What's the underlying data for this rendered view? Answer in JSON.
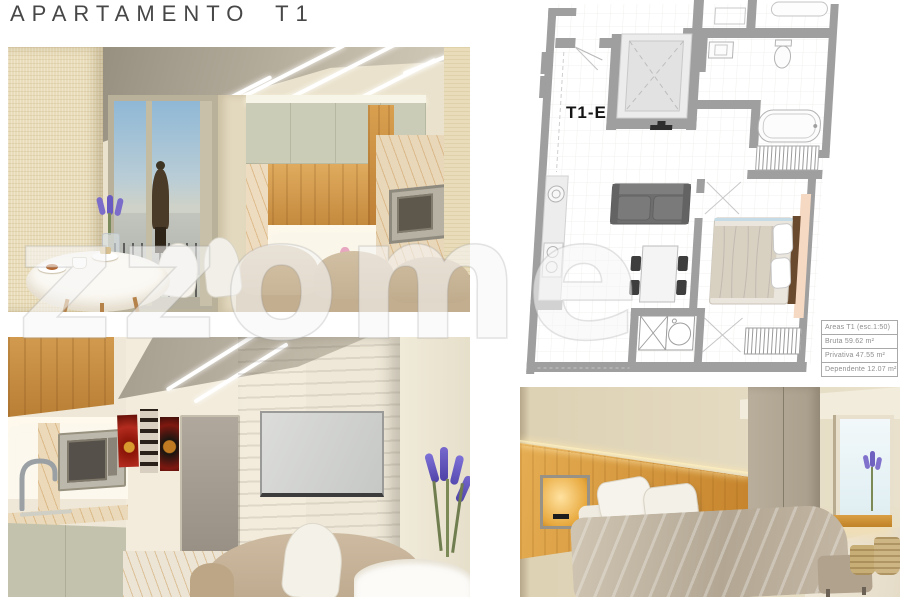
{
  "page": {
    "title": "APARTAMENTO T1"
  },
  "watermark": {
    "symbol": "z",
    "text": "zome"
  },
  "floor_plan": {
    "unit_label": "T1-E",
    "area_table": {
      "rows": [
        "Areas T1 (esc.1:50)",
        "Bruta 59.62 m²",
        "Privativa 47.55 m²",
        "Dependente 12.07 m²"
      ]
    }
  },
  "colors": {
    "plan_wall_gray": "#9f9f9f",
    "accent_peach": "#f6d9c3",
    "cabinet_sage": "#c9cab5",
    "wood_oak": "#d09a52",
    "concrete": "#aaa398",
    "lavender_purple": "#7a6bd0"
  }
}
